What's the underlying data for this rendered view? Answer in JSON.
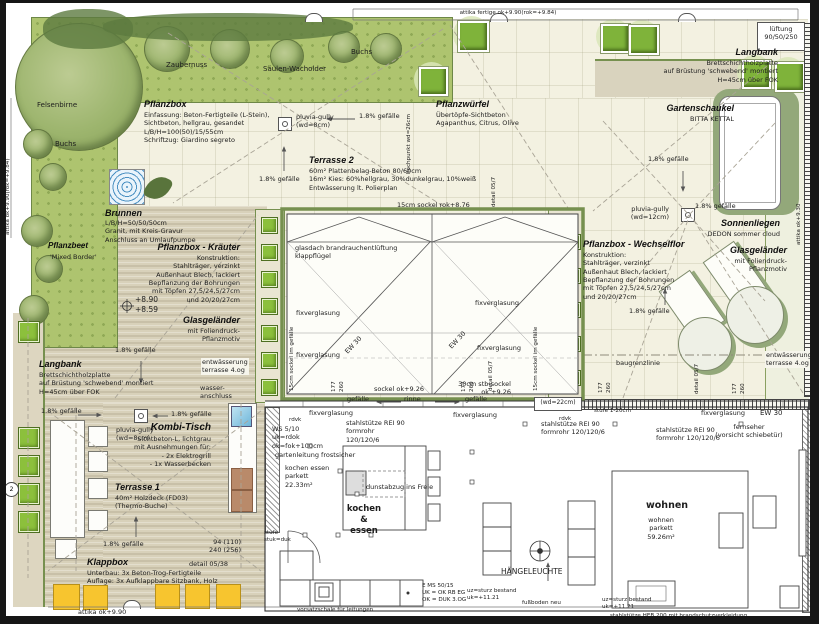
{
  "attika": {
    "top": "attika fertige ok+9.90(rok=+9.84)",
    "left": "attika ok+9.90(rok=+9.84)",
    "bottom": "attika ok+9.90",
    "right": "attika ok+9.30"
  },
  "garden": {
    "felsenbirne": "Felsenbirne",
    "buchs1": "Buchs",
    "zaubernuss": "Zaubernuss",
    "saeulen_wacholder": "Säulen-Wacholder",
    "buchs2": "Buchs",
    "pflanzbeet_title": "Pflanzbeet",
    "pflanzbeet_sub": "'Mixed Border'"
  },
  "annotations": {
    "pflanzbox": {
      "title": "Pflanzbox",
      "body": "Einfassung: Beton-Fertigteile (L-Stein),\nSichtbeton, hellgrau, gesandet\nL/B/H=100(50)/15/55cm\nSchriftzug: Giardino segreto"
    },
    "terrasse2": {
      "title": "Terrasse 2",
      "body": "60m² Plattenbelag-Beton 80/60cm\n16m² Kies: 60%hellgrau, 30%dunkelgrau, 10%weiß\nEntwässerung lt. Polierplan"
    },
    "brunnen": {
      "title": "Brunnen",
      "body": "L/B/H=50/50/50cm\nGranit, mit Kreis-Gravur\nAnschluss an Umlaufpumpe"
    },
    "pflanzbox_kraeuter": {
      "title": "Pflanzbox - Kräuter",
      "body": "Konstruktion:\nStahlträger, verzinkt\nAußenhaut Blech, lackiert\nBepflanzung der Bohrungen\nmit Töpfen 27,5/24,5/27cm\nund 20/20/27cm"
    },
    "glasgelaender_left": {
      "title": "Glasgeländer",
      "body": "mit Foliendruck-\nPflanzmotiv"
    },
    "langbank_left": {
      "title": "Langbank",
      "body": "Brettschichtholzplatte\nauf Brüstung 'schwebend' montiert\nH=45cm über FOK"
    },
    "langbank_right": {
      "title": "Langbank",
      "body": "Brettschichtholzplatte\nauf Brüstung 'schwebend' montiert\nH=45cm über FOK"
    },
    "pflanzwuerfel": {
      "title": "Pflanzwürfel",
      "body": "Übertöpfe-Sichtbeton\nAgapanthus, Citrus, Olive"
    },
    "gartenschaukel": {
      "title": "Gartenschaukel",
      "body": "BITTA KETTAL"
    },
    "sonnenliegen": {
      "title": "Sonnenliegen",
      "body": "DEDON sommer cloud"
    },
    "glasgelaender_right": {
      "title": "Glasgeländer",
      "body": "mit Foliendruck-\nPflanzmotiv"
    },
    "pflanzbox_wechselflor": {
      "title": "Pflanzbox - Wechselflor",
      "body": "Konstruktion:\nStahlträger, verzinkt\nAußenhaut Blech, lackiert\nBepflanzung der Bohrungen\nmit Töpfen 27,5/24,5/27cm\nund 20/20/27cm"
    },
    "kombi_tisch": {
      "title": "Kombi-Tisch",
      "body": "Sichtbeton-L, lichtgrau\nmit Ausnehmungen für:\n- 2x Elektrogrill\n- 1x Wasserbecken"
    },
    "terrasse1": {
      "title": "Terrasse 1",
      "body": "40m² Holzdeck (FD03)\n(Thermo-Buche)"
    },
    "klappbox": {
      "title": "Klappbox",
      "body": "Unterbau: 3x Beton-Trog-Fertigteile\nAuflage: 3x Aufklappbare Sitzbank, Holz"
    },
    "lueftung": "lüftung\n90/50/250"
  },
  "notes": {
    "gefaelle": "1.8% gefälle",
    "pluvia8": "pluvia-gully\n(wd=8cm)",
    "pluvia12": "pluvia-gully\n(wd=12cm)",
    "sockel_top": "15cm sockel rok+8.76",
    "glasdach": "glasdach brandrauchentlüftung\nklappflügel",
    "fixverglasung": "fixverglasung",
    "ew30": "EW 30",
    "sockel_seite": "15cm sockel im gefälle",
    "sockel_ok": "sockel ok+9.26",
    "stb_sockel": "30cm stb-sockel\nok +9.26",
    "gefaelle_w": "gefälle",
    "rinne": "rinne",
    "detail057": "detail 05/7",
    "detail0538": "detail 05/38",
    "hochpunkt": "hochpunkt wd=26cm",
    "baugrenzlinie": "baugrenzlinie",
    "entwaesserung": "entwässerung\nterrasse 4.og",
    "wasseranschluss": "wasser-\nanschluss",
    "hoehen": "+8.90\n+8.59",
    "dim177": "177",
    "dim260": "260",
    "dim94": "94 (110)\n240 (256)",
    "wd22": "(wd=22cm)",
    "stufe120": "stufe 1-20cm",
    "rdvk": "rdvk",
    "ws510": "WS 5/10\nuk=rdok\nok=fok+100cm",
    "stahlstuetze3": "stahlstütze REI 90\nformrohr\n120/120/6",
    "stahlstuetze2": "stahlstütze REI 90\nformrohr 120/120/6",
    "gartenleitung": "gartenleitung frostsicher",
    "kochen_raum": "kochen essen\nparkett\n22.33m²",
    "dunstabzug": "dunstabzug ins Freie",
    "kochen_essen": "kochen\n&\nessen",
    "wohnen_bold": "wohnen",
    "wohnen_raum": "wohnen\nparkett\n59.26m²",
    "haengeleuchte": "HÄNGELEUCHTE",
    "fernseher": "fernseher\n(vorsicht schiebetür)",
    "ems": "E MS 50/15\nUK = OK RB EG\nOK = DUK 3.OG",
    "uz_sturz": "uz=sturz bestand\nuk=+11.21",
    "fussboden": "fußboden neu",
    "heb200": "stahlstütze HEB 200 mit brandschutzverkleidung",
    "vorsatzschale": "vorsatzschale für leitungen",
    "stufe": "stufe\nstuk=duk",
    "marker2": "2"
  },
  "colors": {
    "lawn_green": "#aec46f",
    "plant_green": "#8cc03c",
    "deck_tan": "#d8d1ba",
    "terrace_cream": "#f3f1e1",
    "bench_yellow": "#f7c52f",
    "water_blue": "#8ecae6",
    "frame_green": "#76904f",
    "grill_brown": "#b98a6a"
  }
}
